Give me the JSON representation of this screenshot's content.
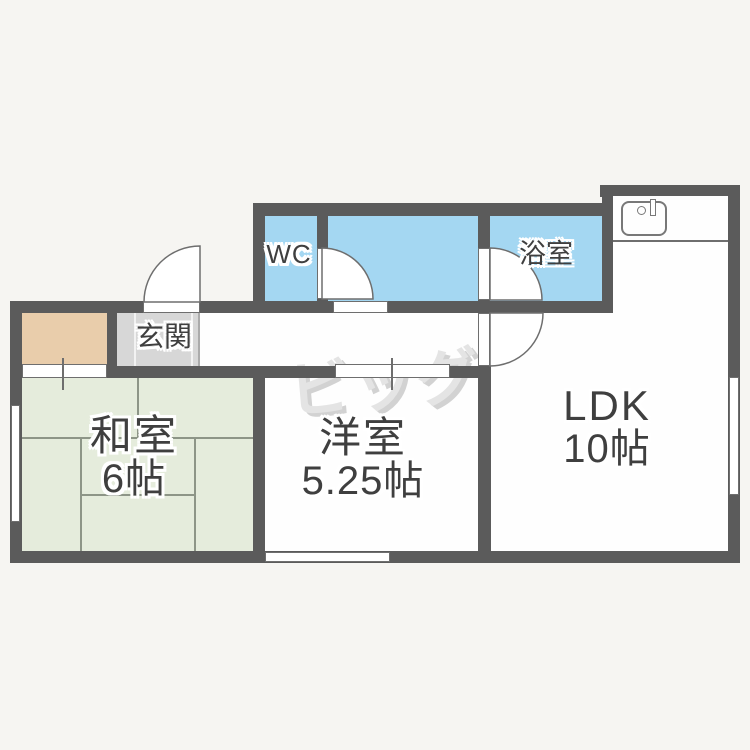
{
  "plan_title": "apartment-floor-plan",
  "watermark_text": "ビッグ",
  "rooms": {
    "wc": {
      "label": "WC"
    },
    "bath": {
      "label": "浴室"
    },
    "genkan": {
      "label": "玄関"
    },
    "japanese_room": {
      "label": "和室",
      "size": "6帖"
    },
    "western_room": {
      "label": "洋室",
      "size": "5.25帖"
    },
    "ldk": {
      "label": "LDK",
      "size": "10帖"
    }
  },
  "fixtures": {
    "kitchen_sink_icon": "sink-icon",
    "doors": [
      "entry-hinged-door",
      "wc-hinged-door",
      "bath-hinged-door",
      "ldk-hinged-door"
    ],
    "sliding_doors": [
      "closet-sliding-door",
      "western-room-sliding-door"
    ],
    "windows": [
      "window-left",
      "window-bottom",
      "window-right"
    ]
  },
  "colors": {
    "wall": "#5b5b5b",
    "wet_room_blue": "#a4d7f2",
    "tatami_green": "#e5ecdc",
    "closet_tan": "#e9cdab",
    "genkan_gray": "#d7d7d7",
    "floor_white": "#fefefe",
    "background": "#f6f5f2",
    "line": "#6e6e6e",
    "label_text": "#3f3f3f",
    "watermark_gray": "#e4e4e4"
  }
}
